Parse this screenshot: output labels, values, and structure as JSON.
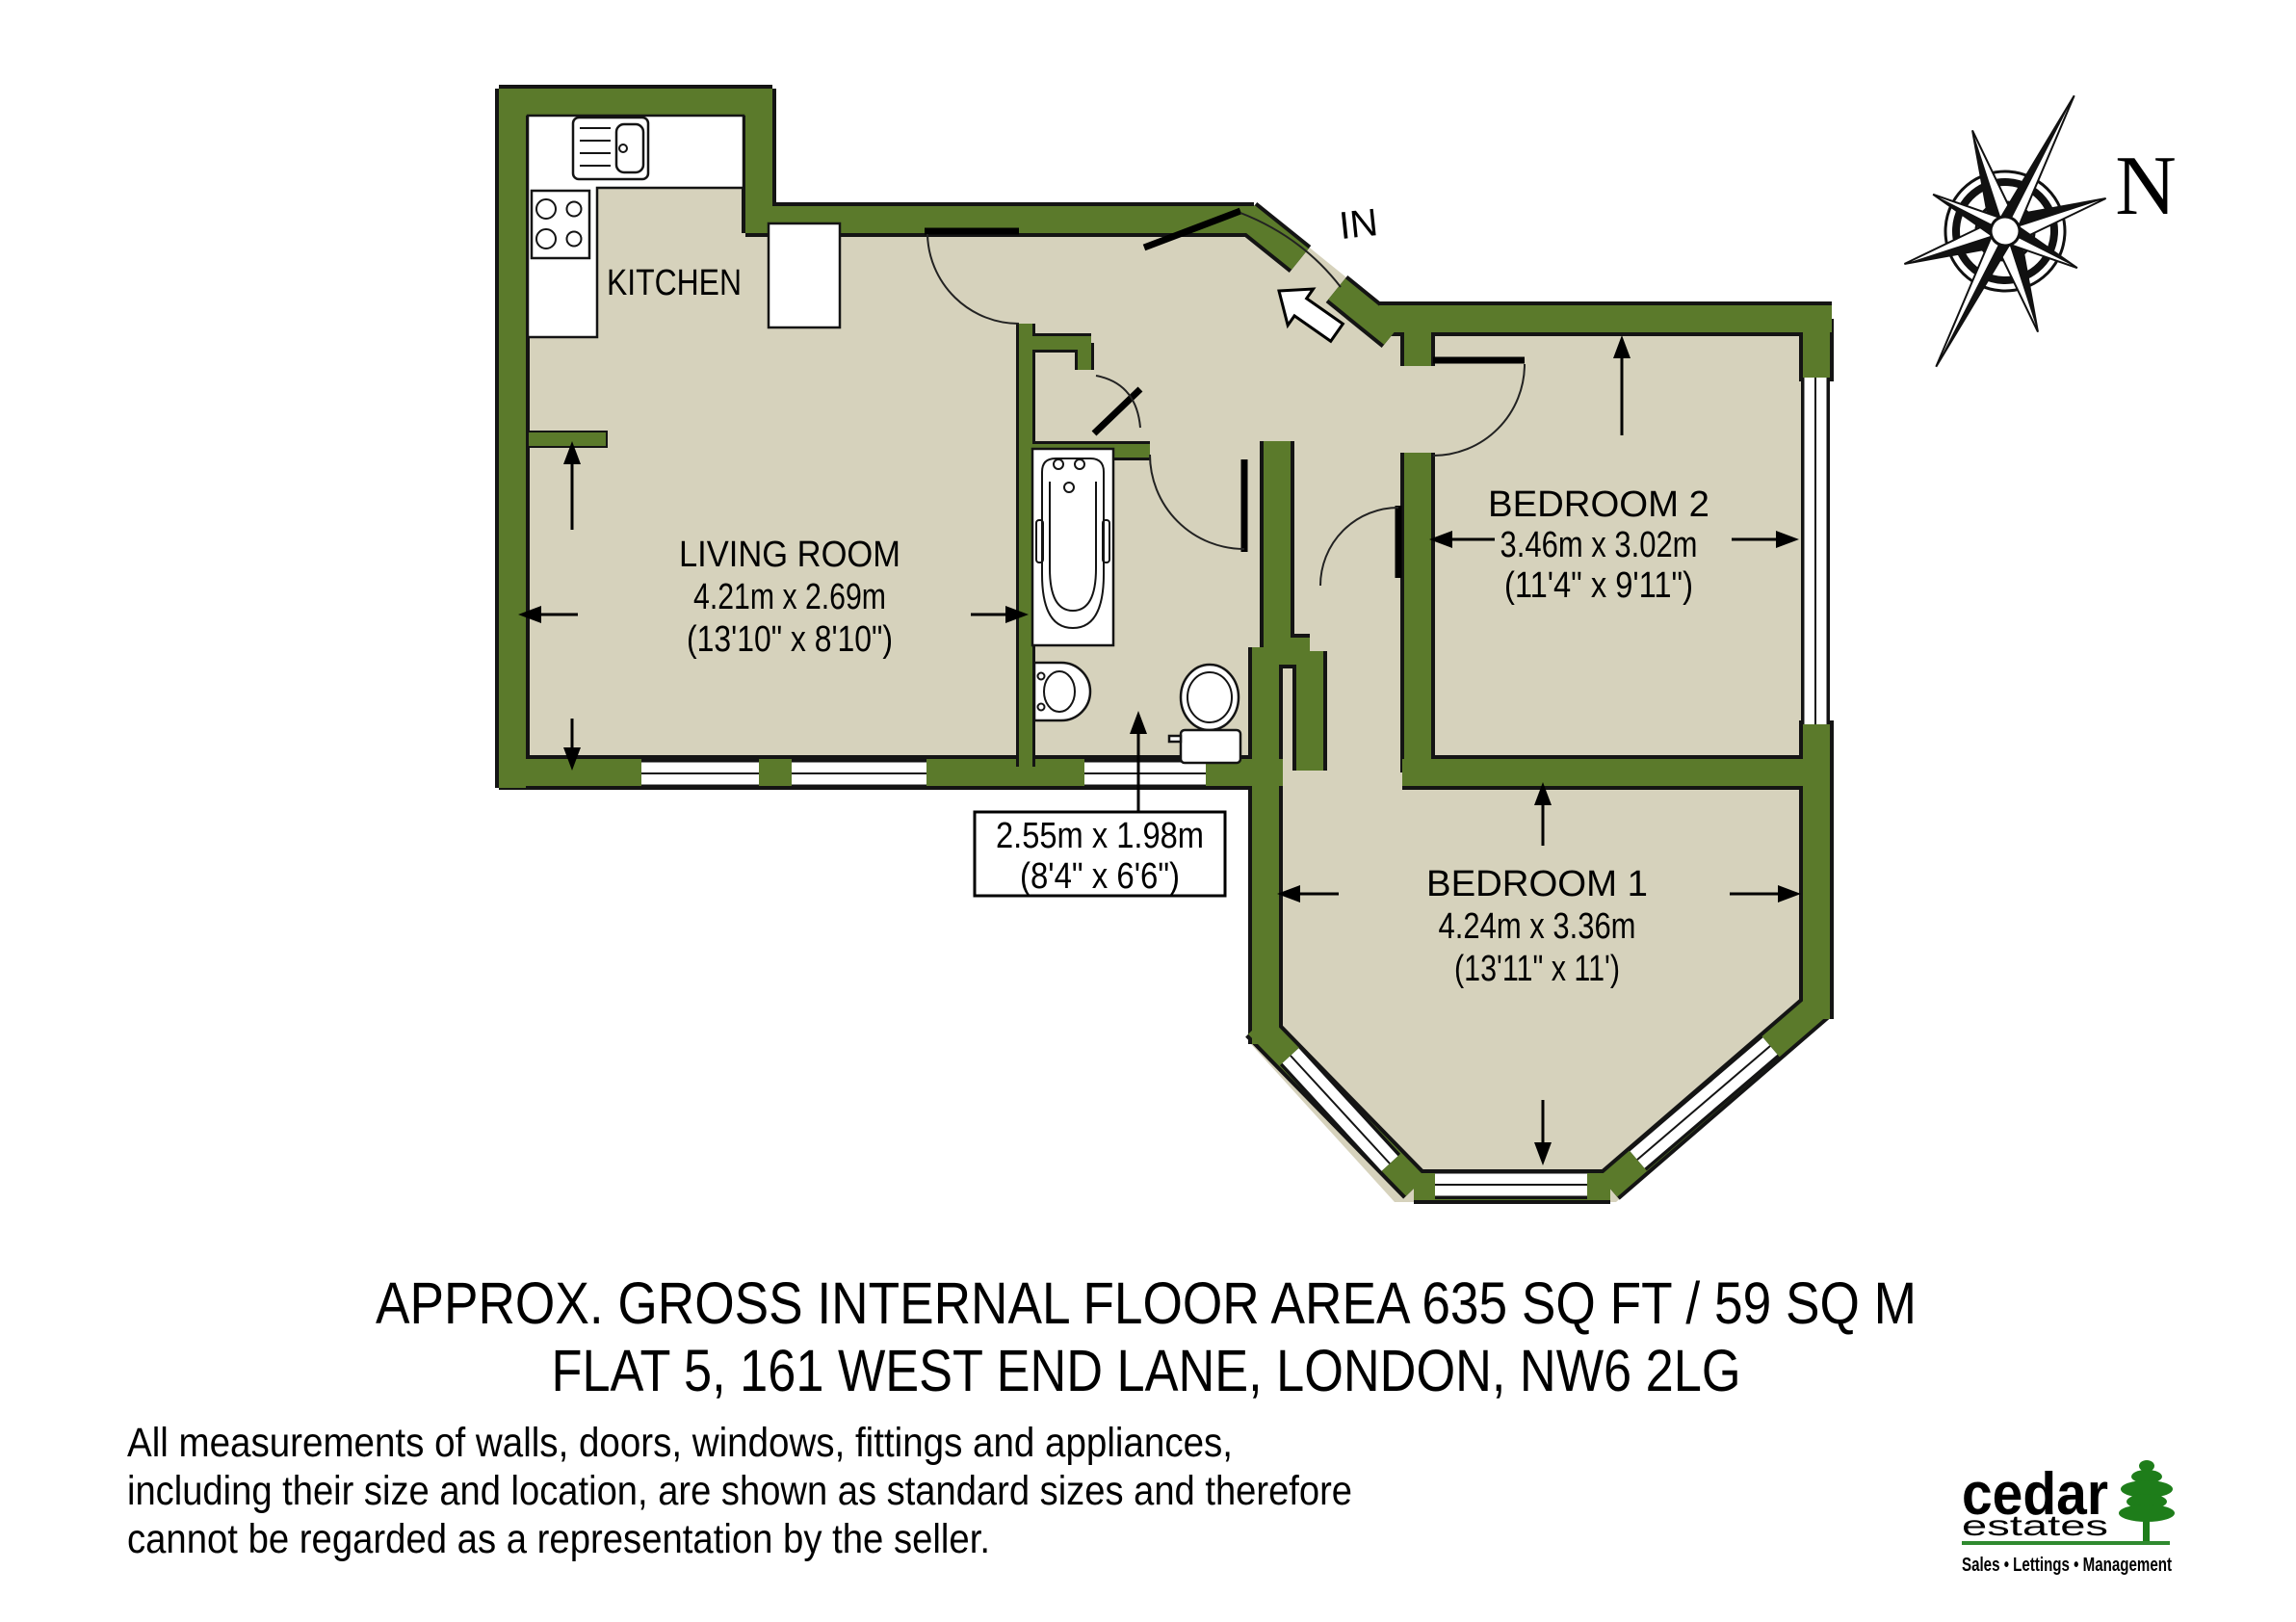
{
  "plan": {
    "compass_label": "N",
    "entrance_label": "IN",
    "rooms": {
      "kitchen": {
        "name": "KITCHEN"
      },
      "living_room": {
        "name": "LIVING ROOM",
        "size_metric": "4.21m x 2.69m",
        "size_imperial": "(13'10\" x 8'10\")"
      },
      "bathroom": {
        "size_metric": "2.55m x 1.98m",
        "size_imperial": "(8'4\" x 6'6\")"
      },
      "bedroom_2": {
        "name": "BEDROOM 2",
        "size_metric": "3.46m x 3.02m",
        "size_imperial": "(11'4\" x 9'11\")"
      },
      "bedroom_1": {
        "name": "BEDROOM 1",
        "size_metric": "4.24m x 3.36m",
        "size_imperial": "(13'11\" x 11')"
      }
    }
  },
  "footer": {
    "area_line": "APPROX. GROSS INTERNAL FLOOR AREA 635 SQ FT / 59 SQ M",
    "address_line": "FLAT 5, 161 WEST END LANE, LONDON, NW6 2LG",
    "disclaimer": [
      "All measurements of walls, doors, windows, fittings and appliances,",
      "including their size and location, are shown as standard sizes and therefore",
      "cannot be regarded as a representation by the seller."
    ]
  },
  "logo": {
    "brand": "cedar",
    "brand_sub": "estates",
    "tagline": "Sales • Lettings • Management"
  },
  "colors": {
    "wall": "#5b7a2b",
    "floor": "#d6d2bc",
    "logo_text": "#47323a",
    "logo_green": "#2f8a2f",
    "tree_green": "#1e7d1a"
  }
}
